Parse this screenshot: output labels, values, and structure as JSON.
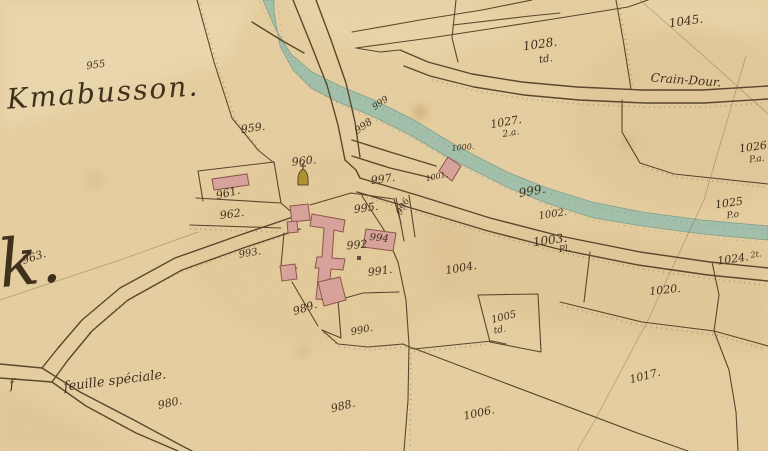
{
  "map": {
    "kind": "historical-cadastral-map",
    "colors": {
      "paper": "#e7d0a2",
      "paper_light": "#f2e2bc",
      "paper_shade": "#d5b686",
      "river": "#9dbfae",
      "river_edge": "#7b9c8c",
      "ink": "#40311d",
      "line": "#57452a",
      "building": "#d9a39c",
      "building_stroke": "#8a5348",
      "chapel": "#b0912f"
    },
    "icons": {
      "chapel": "dome-with-cross",
      "mill": "rotated-square-on-stream",
      "well_mark": "small-dark-square"
    },
    "labels": [
      {
        "text": "Kmabusson.",
        "x": 103,
        "y": 93,
        "size": 28,
        "rot": -4,
        "kind": "place-large"
      },
      {
        "text": "k.",
        "x": 30,
        "y": 262,
        "size": 66,
        "rot": -6,
        "kind": "place-huge"
      },
      {
        "text": "feuille spéciale.",
        "x": 115,
        "y": 381,
        "size": 13,
        "rot": -7,
        "kind": "place"
      },
      {
        "text": "f",
        "x": 12,
        "y": 385,
        "size": 13,
        "rot": -7,
        "kind": "place"
      },
      {
        "text": "Crain-Dour.",
        "x": 686,
        "y": 80,
        "size": 12,
        "rot": 4,
        "kind": "place"
      },
      {
        "text": "955",
        "x": 96,
        "y": 66,
        "size": 10,
        "rot": -8
      },
      {
        "text": "959.",
        "x": 253,
        "y": 128,
        "size": 11,
        "rot": -8
      },
      {
        "text": "960.",
        "x": 304,
        "y": 161,
        "size": 11,
        "rot": -6
      },
      {
        "text": "961.",
        "x": 228,
        "y": 193,
        "size": 11,
        "rot": -14
      },
      {
        "text": "962.",
        "x": 232,
        "y": 214,
        "size": 11,
        "rot": -8
      },
      {
        "text": "963.",
        "x": 34,
        "y": 257,
        "size": 11,
        "rot": -18
      },
      {
        "text": "980.",
        "x": 170,
        "y": 403,
        "size": 11,
        "rot": -12
      },
      {
        "text": "988.",
        "x": 343,
        "y": 406,
        "size": 11,
        "rot": -14
      },
      {
        "text": "989.",
        "x": 305,
        "y": 308,
        "size": 11,
        "rot": -18
      },
      {
        "text": "990.",
        "x": 362,
        "y": 331,
        "size": 10,
        "rot": -12
      },
      {
        "text": "991.",
        "x": 380,
        "y": 271,
        "size": 11,
        "rot": -8
      },
      {
        "text": "992",
        "x": 357,
        "y": 245,
        "size": 11,
        "rot": -5
      },
      {
        "text": "993.",
        "x": 250,
        "y": 254,
        "size": 10,
        "rot": -10
      },
      {
        "text": "994",
        "x": 379,
        "y": 239,
        "size": 10,
        "rot": 6
      },
      {
        "text": "995.",
        "x": 366,
        "y": 208,
        "size": 11,
        "rot": -8
      },
      {
        "text": "996",
        "x": 404,
        "y": 207,
        "size": 9,
        "rot": -60
      },
      {
        "text": "997.",
        "x": 383,
        "y": 179,
        "size": 11,
        "rot": -8
      },
      {
        "text": "998",
        "x": 364,
        "y": 127,
        "size": 10,
        "rot": -35
      },
      {
        "text": "999",
        "x": 381,
        "y": 104,
        "size": 9,
        "rot": -35
      },
      {
        "text": "999.",
        "x": 532,
        "y": 191,
        "size": 12,
        "rot": -10
      },
      {
        "text": "1000.",
        "x": 463,
        "y": 148,
        "size": 8,
        "rot": -5
      },
      {
        "text": "1001.",
        "x": 437,
        "y": 177,
        "size": 8,
        "rot": -12
      },
      {
        "text": "1002.",
        "x": 553,
        "y": 215,
        "size": 10,
        "rot": -8
      },
      {
        "text": "1003.",
        "x": 550,
        "y": 240,
        "size": 12,
        "rot": -8
      },
      {
        "text": "1004.",
        "x": 461,
        "y": 268,
        "size": 11,
        "rot": -10
      },
      {
        "text": "1005",
        "x": 504,
        "y": 318,
        "size": 10,
        "rot": -14
      },
      {
        "text": "1006.",
        "x": 479,
        "y": 413,
        "size": 11,
        "rot": -12
      },
      {
        "text": "1017.",
        "x": 645,
        "y": 376,
        "size": 11,
        "rot": -14
      },
      {
        "text": "1020.",
        "x": 665,
        "y": 290,
        "size": 11,
        "rot": -6
      },
      {
        "text": "1024.",
        "x": 733,
        "y": 259,
        "size": 11,
        "rot": -8
      },
      {
        "text": "1025",
        "x": 729,
        "y": 203,
        "size": 11,
        "rot": -8
      },
      {
        "text": "1026",
        "x": 753,
        "y": 147,
        "size": 11,
        "rot": -8
      },
      {
        "text": "1027.",
        "x": 506,
        "y": 122,
        "size": 11,
        "rot": -10
      },
      {
        "text": "1028.",
        "x": 540,
        "y": 44,
        "size": 12,
        "rot": -8
      },
      {
        "text": "1045.",
        "x": 686,
        "y": 21,
        "size": 12,
        "rot": -8
      },
      {
        "text": "td.",
        "x": 546,
        "y": 60,
        "size": 10,
        "rot": -8,
        "kind": "sub"
      },
      {
        "text": "2.a.",
        "x": 511,
        "y": 134,
        "size": 9,
        "rot": -10,
        "kind": "sub"
      },
      {
        "text": "P.a.",
        "x": 757,
        "y": 160,
        "size": 9,
        "rot": -8,
        "kind": "sub"
      },
      {
        "text": "P.o",
        "x": 733,
        "y": 216,
        "size": 9,
        "rot": -8,
        "kind": "sub"
      },
      {
        "text": "2t.",
        "x": 756,
        "y": 255,
        "size": 8,
        "rot": -8,
        "kind": "sub"
      },
      {
        "text": "Pl.",
        "x": 565,
        "y": 250,
        "size": 9,
        "rot": -8,
        "kind": "sub"
      },
      {
        "text": "td.",
        "x": 500,
        "y": 331,
        "size": 9,
        "rot": -10,
        "kind": "sub"
      }
    ]
  }
}
